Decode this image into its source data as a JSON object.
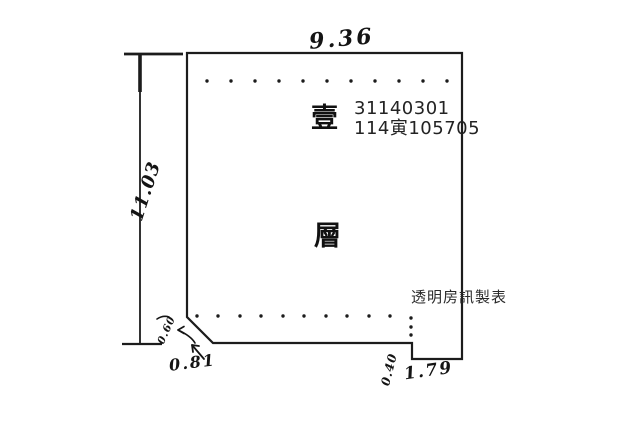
{
  "colors": {
    "ink": "#1c1c1c",
    "print": "#232323",
    "watermark": "#2a2a2a"
  },
  "plan": {
    "floor_label_top": "壹",
    "floor_label_bottom": "層",
    "registration_number": "31140301",
    "case_number": "114寅105705",
    "watermark": "透明房訊製表",
    "dimensions": {
      "top_width": "9.36",
      "left_height": "11.03",
      "chamfer_length": "0.81",
      "left_notch": "0.60",
      "right_notch_height": "0.40",
      "right_notch_width": "1.79"
    }
  }
}
